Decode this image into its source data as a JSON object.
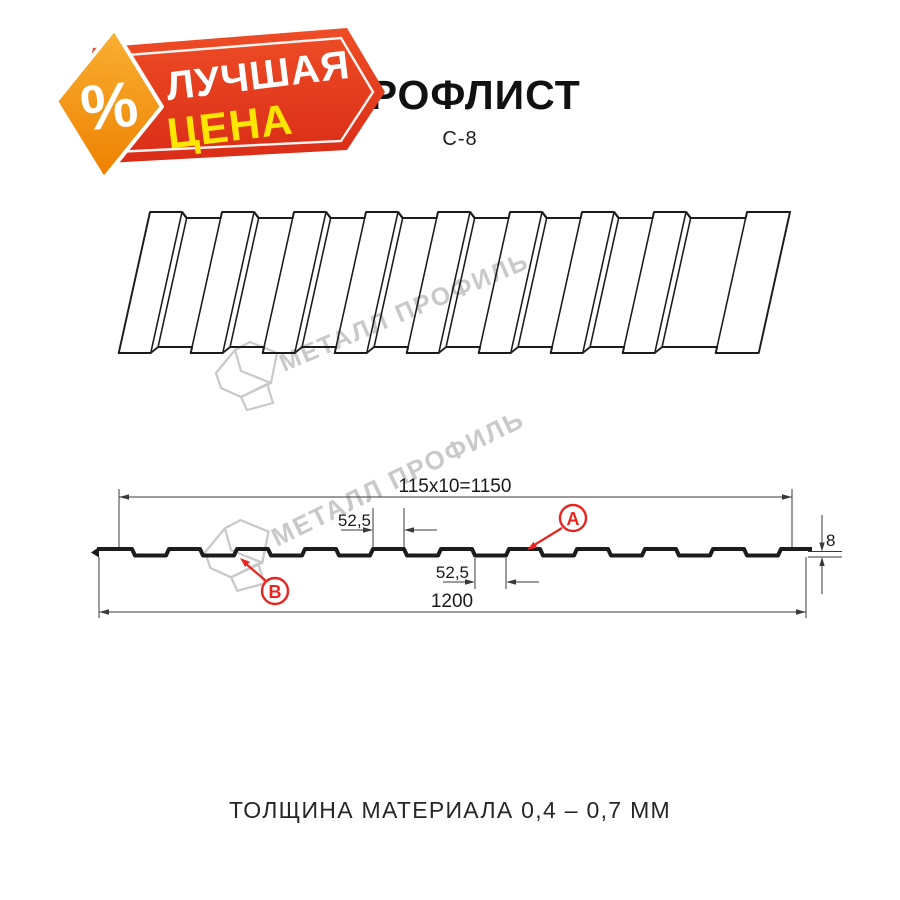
{
  "badge": {
    "percent": "%",
    "line1": "ЛУЧШАЯ",
    "line2": "ЦЕНА"
  },
  "header": {
    "title": "ПРОФЛИСТ",
    "subtitle": "С-8"
  },
  "watermark": {
    "text": "МЕТАЛЛ ПРОФИЛЬ"
  },
  "diagram": {
    "dims": {
      "working_width": "115x10=1150",
      "crest_width": "52,5",
      "valley_width": "52,5",
      "total_width": "1200",
      "height": "8"
    },
    "labels": {
      "a": "А",
      "b": "В"
    },
    "cross_section": {
      "start_x": 97,
      "first_flat": 35,
      "slope": 3,
      "valley": 31,
      "crest": 31,
      "repeats": 10,
      "end_x": 812,
      "y_top": 549,
      "y_bottom": 555.5
    },
    "illustration": {
      "x": 150,
      "y": 212,
      "skew_deg": -12.5,
      "ribs": 8,
      "pitch": 72,
      "crest_w": 32,
      "step_w": 6,
      "top_flat_y": 6,
      "bot_flat_y": 135,
      "bot_crest_y": 141,
      "last_line_x": 597,
      "sheet_w": 640
    }
  },
  "footer": {
    "caption": "ТОЛЩИНА МАТЕРИАЛА 0,4 – 0,7 ММ"
  },
  "colors": {
    "line": "#1c1c1c",
    "dim_line": "#3a3a3a",
    "red_label": "#e8251f",
    "watermark": "#c9c9c9",
    "badge_red_top": "#ee4d26",
    "badge_red_bottom": "#d92c17",
    "badge_orange_top": "#f9b033",
    "badge_orange_bottom": "#ee8000",
    "badge_yellow": "#ffe500"
  }
}
